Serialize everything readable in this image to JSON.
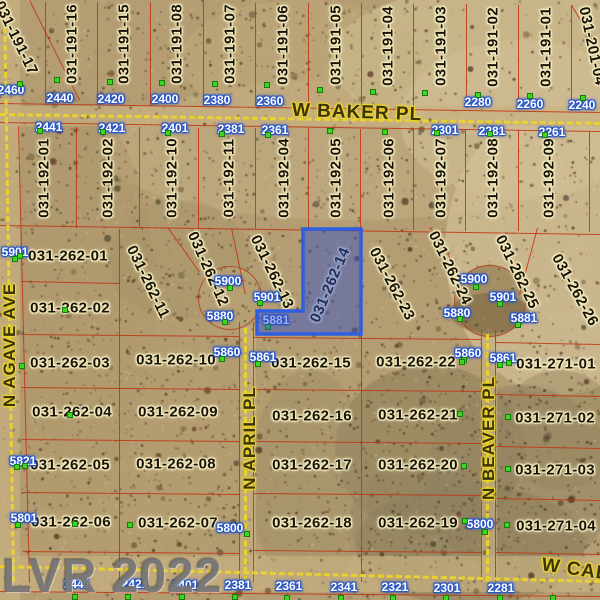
{
  "map": {
    "watermark": "LVR 2022",
    "selected_parcel": {
      "id": "031-262-14",
      "fill": "rgba(44,78,205,0.45)",
      "stroke": "#2e5fe0"
    },
    "colors": {
      "terrain_base": "#b49d72",
      "parcel_line": "#c13614",
      "road_dash": "#ebd32c",
      "label_halo": "#f4ecc2",
      "tag_halo": "#2453c9",
      "marker_green": "#3bd81f",
      "watermark_grey": "#6c6c6c"
    },
    "streets": [
      {
        "name": "W BAKER PL",
        "x": 357,
        "y": 113,
        "rot": 2,
        "big": true
      },
      {
        "name": "N AGAVE AVE",
        "x": 10,
        "y": 345,
        "rot": -90,
        "big": false
      },
      {
        "name": "N APRIL PL",
        "x": 250,
        "y": 438,
        "rot": -90,
        "big": false
      },
      {
        "name": "N BEAVER PL",
        "x": 489,
        "y": 438,
        "rot": -90,
        "big": false
      },
      {
        "name": "W CAL",
        "x": 575,
        "y": 570,
        "rot": 8,
        "big": true
      }
    ],
    "parcel_labels": [
      {
        "id": "031-191-17",
        "x": 16,
        "y": 38,
        "rot": 64
      },
      {
        "id": "031-191-16",
        "x": 72,
        "y": 44,
        "rot": -90
      },
      {
        "id": "031-191-15",
        "x": 124,
        "y": 44,
        "rot": -90
      },
      {
        "id": "031-191-08",
        "x": 177,
        "y": 44,
        "rot": -90
      },
      {
        "id": "031-191-07",
        "x": 230,
        "y": 44,
        "rot": -90
      },
      {
        "id": "031-191-06",
        "x": 283,
        "y": 45,
        "rot": -90
      },
      {
        "id": "031-191-05",
        "x": 336,
        "y": 45,
        "rot": -90
      },
      {
        "id": "031-191-04",
        "x": 388,
        "y": 46,
        "rot": -90
      },
      {
        "id": "031-191-03",
        "x": 441,
        "y": 46,
        "rot": -90
      },
      {
        "id": "031-191-02",
        "x": 493,
        "y": 47,
        "rot": -90
      },
      {
        "id": "031-191-01",
        "x": 546,
        "y": 47,
        "rot": -90
      },
      {
        "id": "031-201-04",
        "x": 592,
        "y": 46,
        "rot": 78
      },
      {
        "id": "031-192-01",
        "x": 44,
        "y": 178,
        "rot": -90
      },
      {
        "id": "031-192-02",
        "x": 108,
        "y": 178,
        "rot": -90
      },
      {
        "id": "031-192-10",
        "x": 172,
        "y": 178,
        "rot": -90
      },
      {
        "id": "031-192-11",
        "x": 229,
        "y": 178,
        "rot": -90
      },
      {
        "id": "031-192-04",
        "x": 284,
        "y": 178,
        "rot": -90
      },
      {
        "id": "031-192-05",
        "x": 336,
        "y": 178,
        "rot": -90
      },
      {
        "id": "031-192-06",
        "x": 389,
        "y": 178,
        "rot": -90
      },
      {
        "id": "031-192-07",
        "x": 441,
        "y": 178,
        "rot": -90
      },
      {
        "id": "031-192-08",
        "x": 493,
        "y": 178,
        "rot": -90
      },
      {
        "id": "031-192-09",
        "x": 549,
        "y": 178,
        "rot": -90
      },
      {
        "id": "031-262-01",
        "x": 68,
        "y": 256,
        "rot": 0
      },
      {
        "id": "031-262-02",
        "x": 70,
        "y": 308,
        "rot": 0
      },
      {
        "id": "031-262-11",
        "x": 148,
        "y": 282,
        "rot": 64
      },
      {
        "id": "031-262-12",
        "x": 208,
        "y": 269,
        "rot": 66
      },
      {
        "id": "031-262-13",
        "x": 272,
        "y": 272,
        "rot": 64
      },
      {
        "id": "031-262-14",
        "x": 330,
        "y": 285,
        "rot": -67
      },
      {
        "id": "031-262-23",
        "x": 392,
        "y": 284,
        "rot": 62
      },
      {
        "id": "031-262-24",
        "x": 450,
        "y": 268,
        "rot": 64
      },
      {
        "id": "031-262-25",
        "x": 517,
        "y": 272,
        "rot": 64
      },
      {
        "id": "031-262-26",
        "x": 575,
        "y": 290,
        "rot": 61
      },
      {
        "id": "031-262-03",
        "x": 70,
        "y": 363,
        "rot": 0
      },
      {
        "id": "031-262-10",
        "x": 176,
        "y": 360,
        "rot": 0
      },
      {
        "id": "031-262-15",
        "x": 311,
        "y": 363,
        "rot": 0
      },
      {
        "id": "031-262-22",
        "x": 416,
        "y": 362,
        "rot": 0
      },
      {
        "id": "031-271-01",
        "x": 556,
        "y": 364,
        "rot": 0
      },
      {
        "id": "031-262-04",
        "x": 72,
        "y": 412,
        "rot": 0
      },
      {
        "id": "031-262-09",
        "x": 178,
        "y": 412,
        "rot": 0
      },
      {
        "id": "031-262-16",
        "x": 312,
        "y": 416,
        "rot": 0
      },
      {
        "id": "031-262-21",
        "x": 418,
        "y": 415,
        "rot": 0
      },
      {
        "id": "031-271-02",
        "x": 555,
        "y": 418,
        "rot": 0
      },
      {
        "id": "031-262-05",
        "x": 70,
        "y": 465,
        "rot": 0
      },
      {
        "id": "031-262-08",
        "x": 176,
        "y": 464,
        "rot": 0
      },
      {
        "id": "031-262-17",
        "x": 312,
        "y": 465,
        "rot": 0
      },
      {
        "id": "031-262-20",
        "x": 418,
        "y": 465,
        "rot": 0
      },
      {
        "id": "031-271-03",
        "x": 555,
        "y": 470,
        "rot": 0
      },
      {
        "id": "031-262-06",
        "x": 71,
        "y": 522,
        "rot": 0
      },
      {
        "id": "031-262-07",
        "x": 178,
        "y": 523,
        "rot": 0
      },
      {
        "id": "031-262-18",
        "x": 312,
        "y": 523,
        "rot": 0
      },
      {
        "id": "031-262-19",
        "x": 418,
        "y": 523,
        "rot": 0
      },
      {
        "id": "031-271-04",
        "x": 556,
        "y": 526,
        "rot": 0
      }
    ],
    "address_tags": [
      {
        "n": "2460",
        "x": 11,
        "y": 90
      },
      {
        "n": "2440",
        "x": 60,
        "y": 98
      },
      {
        "n": "2420",
        "x": 111,
        "y": 99
      },
      {
        "n": "2400",
        "x": 165,
        "y": 99
      },
      {
        "n": "2380",
        "x": 217,
        "y": 100
      },
      {
        "n": "2360",
        "x": 270,
        "y": 101
      },
      {
        "n": "2280",
        "x": 478,
        "y": 102
      },
      {
        "n": "2260",
        "x": 530,
        "y": 104
      },
      {
        "n": "2240",
        "x": 582,
        "y": 105
      },
      {
        "n": "2441",
        "x": 49,
        "y": 127
      },
      {
        "n": "2421",
        "x": 112,
        "y": 128
      },
      {
        "n": "2401",
        "x": 175,
        "y": 128
      },
      {
        "n": "2381",
        "x": 231,
        "y": 129
      },
      {
        "n": "2361",
        "x": 275,
        "y": 130
      },
      {
        "n": "2301",
        "x": 445,
        "y": 130
      },
      {
        "n": "2281",
        "x": 492,
        "y": 131
      },
      {
        "n": "2261",
        "x": 552,
        "y": 132
      },
      {
        "n": "5901",
        "x": 15,
        "y": 252
      },
      {
        "n": "5900",
        "x": 228,
        "y": 281
      },
      {
        "n": "5901",
        "x": 267,
        "y": 297
      },
      {
        "n": "5880",
        "x": 220,
        "y": 316
      },
      {
        "n": "5881",
        "x": 276,
        "y": 320
      },
      {
        "n": "5860",
        "x": 227,
        "y": 352
      },
      {
        "n": "5861",
        "x": 263,
        "y": 357
      },
      {
        "n": "5821",
        "x": 23,
        "y": 461
      },
      {
        "n": "5801",
        "x": 24,
        "y": 518
      },
      {
        "n": "5800",
        "x": 230,
        "y": 528
      },
      {
        "n": "5900",
        "x": 474,
        "y": 279
      },
      {
        "n": "5901",
        "x": 503,
        "y": 297
      },
      {
        "n": "5880",
        "x": 457,
        "y": 313
      },
      {
        "n": "5881",
        "x": 524,
        "y": 318
      },
      {
        "n": "5860",
        "x": 468,
        "y": 353
      },
      {
        "n": "5861",
        "x": 503,
        "y": 358
      },
      {
        "n": "5800",
        "x": 480,
        "y": 524
      },
      {
        "n": "2441",
        "x": 77,
        "y": 584
      },
      {
        "n": "2421",
        "x": 135,
        "y": 584
      },
      {
        "n": "2401",
        "x": 185,
        "y": 585
      },
      {
        "n": "2381",
        "x": 238,
        "y": 585
      },
      {
        "n": "2361",
        "x": 289,
        "y": 586
      },
      {
        "n": "2341",
        "x": 344,
        "y": 587
      },
      {
        "n": "2321",
        "x": 395,
        "y": 587
      },
      {
        "n": "2301",
        "x": 447,
        "y": 588
      },
      {
        "n": "2281",
        "x": 501,
        "y": 588
      }
    ],
    "markers": [
      [
        57,
        80
      ],
      [
        110,
        82
      ],
      [
        162,
        83
      ],
      [
        215,
        84
      ],
      [
        267,
        85
      ],
      [
        320,
        90
      ],
      [
        373,
        92
      ],
      [
        425,
        93
      ],
      [
        478,
        95
      ],
      [
        530,
        96
      ],
      [
        583,
        98
      ],
      [
        20,
        84
      ],
      [
        40,
        131
      ],
      [
        103,
        132
      ],
      [
        168,
        133
      ],
      [
        222,
        134
      ],
      [
        268,
        135
      ],
      [
        330,
        131
      ],
      [
        385,
        132
      ],
      [
        437,
        133
      ],
      [
        490,
        134
      ],
      [
        545,
        135
      ],
      [
        20,
        256
      ],
      [
        65,
        310
      ],
      [
        22,
        366
      ],
      [
        70,
        415
      ],
      [
        25,
        466
      ],
      [
        75,
        524
      ],
      [
        130,
        525
      ],
      [
        230,
        288
      ],
      [
        260,
        303
      ],
      [
        225,
        322
      ],
      [
        268,
        327
      ],
      [
        222,
        359
      ],
      [
        258,
        364
      ],
      [
        15,
        259
      ],
      [
        17,
        467
      ],
      [
        18,
        525
      ],
      [
        476,
        287
      ],
      [
        500,
        304
      ],
      [
        460,
        319
      ],
      [
        518,
        325
      ],
      [
        464,
        360
      ],
      [
        500,
        365
      ],
      [
        462,
        362
      ],
      [
        460,
        414
      ],
      [
        464,
        466
      ],
      [
        465,
        521
      ],
      [
        509,
        363
      ],
      [
        508,
        417
      ],
      [
        508,
        469
      ],
      [
        507,
        525
      ],
      [
        247,
        534
      ],
      [
        485,
        532
      ],
      [
        75,
        597
      ],
      [
        128,
        597
      ],
      [
        182,
        597
      ],
      [
        235,
        597
      ],
      [
        287,
        598
      ],
      [
        341,
        598
      ],
      [
        393,
        598
      ],
      [
        446,
        598
      ],
      [
        500,
        598
      ],
      [
        553,
        598
      ]
    ],
    "geometry": {
      "selected_polygon": "303,229 361,229 361,334 257,334 257,311 303,311",
      "culdesacs": [
        {
          "x": 230,
          "y": 298,
          "r": 32
        },
        {
          "x": 490,
          "y": 301,
          "r": 36
        }
      ],
      "red_lines": [
        [
          46,
          2,
          46,
          105
        ],
        [
          98,
          2,
          98,
          105
        ],
        [
          151,
          2,
          151,
          106
        ],
        [
          204,
          2,
          204,
          106
        ],
        [
          256,
          3,
          256,
          106
        ],
        [
          309,
          3,
          309,
          107
        ],
        [
          362,
          3,
          362,
          107
        ],
        [
          414,
          4,
          414,
          108
        ],
        [
          467,
          4,
          467,
          108
        ],
        [
          519,
          5,
          519,
          109
        ],
        [
          572,
          5,
          572,
          109
        ],
        [
          30,
          0,
          80,
          100
        ],
        [
          572,
          5,
          596,
          45
        ],
        [
          0,
          103,
          600,
          112
        ],
        [
          0,
          122,
          600,
          131
        ],
        [
          77,
          127,
          77,
          228
        ],
        [
          140,
          127,
          140,
          228
        ],
        [
          199,
          128,
          199,
          229
        ],
        [
          256,
          128,
          256,
          229
        ],
        [
          309,
          128,
          309,
          230
        ],
        [
          361,
          129,
          361,
          230
        ],
        [
          414,
          129,
          414,
          230
        ],
        [
          466,
          130,
          466,
          231
        ],
        [
          519,
          130,
          519,
          231
        ],
        [
          590,
          131,
          590,
          232
        ],
        [
          0,
          225,
          600,
          234
        ],
        [
          19,
          126,
          30,
          583
        ],
        [
          120,
          229,
          120,
          582
        ],
        [
          21,
          281,
          120,
          283
        ],
        [
          21,
          334,
          240,
          336
        ],
        [
          21,
          387,
          240,
          389
        ],
        [
          22,
          439,
          240,
          441
        ],
        [
          22,
          492,
          240,
          494
        ],
        [
          23,
          551,
          240,
          553
        ],
        [
          240,
          322,
          240,
          582
        ],
        [
          254,
          322,
          254,
          582
        ],
        [
          362,
          336,
          362,
          582
        ],
        [
          254,
          337,
          482,
          339
        ],
        [
          254,
          389,
          482,
          391
        ],
        [
          254,
          441,
          482,
          443
        ],
        [
          254,
          493,
          482,
          495
        ],
        [
          254,
          550,
          482,
          552
        ],
        [
          482,
          330,
          482,
          582
        ],
        [
          496,
          330,
          496,
          582
        ],
        [
          496,
          342,
          600,
          344
        ],
        [
          496,
          394,
          600,
          396
        ],
        [
          496,
          446,
          600,
          448
        ],
        [
          496,
          498,
          600,
          500
        ],
        [
          496,
          552,
          600,
          554
        ],
        [
          168,
          227,
          200,
          272
        ],
        [
          232,
          228,
          246,
          295
        ],
        [
          430,
          227,
          460,
          272
        ],
        [
          538,
          228,
          520,
          295
        ],
        [
          0,
          591,
          600,
          596
        ],
        [
          75,
          593,
          75,
          600
        ],
        [
          128,
          593,
          128,
          600
        ],
        [
          182,
          593,
          182,
          600
        ],
        [
          235,
          593,
          235,
          600
        ],
        [
          288,
          593,
          288,
          600
        ],
        [
          341,
          593,
          341,
          600
        ],
        [
          394,
          593,
          394,
          600
        ],
        [
          447,
          593,
          447,
          600
        ],
        [
          500,
          593,
          500,
          600
        ],
        [
          553,
          593,
          553,
          600
        ]
      ],
      "roads": [
        [
          0,
          113,
          600,
          122
        ],
        [
          6,
          0,
          15,
          582
        ],
        [
          247,
          328,
          247,
          582
        ],
        [
          489,
          334,
          489,
          582
        ],
        [
          0,
          565,
          600,
          580
        ]
      ]
    }
  }
}
